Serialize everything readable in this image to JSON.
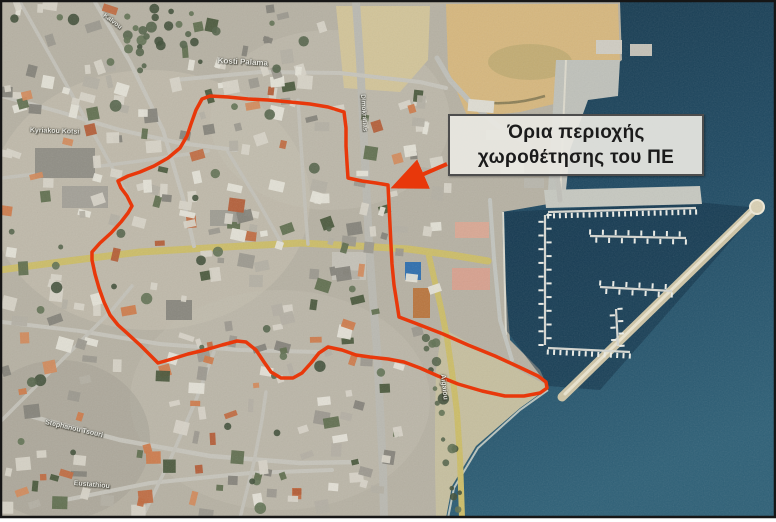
{
  "map": {
    "type": "satellite-aerial-photo",
    "callout": {
      "line1": "Όρια περιοχής",
      "line2": "χωροθέτησης του ΠΕ"
    },
    "street_labels": [
      {
        "text": "Kosti Palama",
        "x": 218,
        "y": 56,
        "rot": 3,
        "size": 8
      },
      {
        "text": "Kyriakou Kotsi",
        "x": 30,
        "y": 127,
        "rot": 2,
        "size": 7
      },
      {
        "text": "Kalvou",
        "x": 106,
        "y": 12,
        "rot": 38,
        "size": 6.5
      },
      {
        "text": "Dimokratias",
        "x": 366,
        "y": 94,
        "rot": 86,
        "size": 6.5
      },
      {
        "text": "Stephanou Tsouri",
        "x": 46,
        "y": 419,
        "rot": 13,
        "size": 7
      },
      {
        "text": "Eustathiou",
        "x": 74,
        "y": 480,
        "rot": 5,
        "size": 7
      },
      {
        "text": "Aigaiou",
        "x": 446,
        "y": 374,
        "rot": 84,
        "size": 7
      }
    ],
    "boundary": {
      "color": "#e8380b",
      "stroke_width": 3.5,
      "points": [
        [
          210,
          96
        ],
        [
          228,
          97
        ],
        [
          248,
          99
        ],
        [
          268,
          100
        ],
        [
          290,
          102
        ],
        [
          310,
          104
        ],
        [
          328,
          107
        ],
        [
          344,
          112
        ],
        [
          346,
          128
        ],
        [
          346,
          146
        ],
        [
          347,
          163
        ],
        [
          348,
          178
        ],
        [
          362,
          181
        ],
        [
          376,
          183
        ],
        [
          388,
          185
        ],
        [
          389,
          205
        ],
        [
          390,
          225
        ],
        [
          391,
          245
        ],
        [
          392,
          264
        ],
        [
          394,
          285
        ],
        [
          397,
          304
        ],
        [
          399,
          317
        ],
        [
          420,
          325
        ],
        [
          443,
          334
        ],
        [
          468,
          345
        ],
        [
          495,
          356
        ],
        [
          519,
          367
        ],
        [
          538,
          376
        ],
        [
          546,
          382
        ],
        [
          547,
          388
        ],
        [
          540,
          393
        ],
        [
          524,
          396
        ],
        [
          505,
          396
        ],
        [
          482,
          391
        ],
        [
          458,
          384
        ],
        [
          438,
          376
        ],
        [
          420,
          368
        ],
        [
          404,
          362
        ],
        [
          388,
          359
        ],
        [
          370,
          357
        ],
        [
          356,
          355
        ],
        [
          342,
          350
        ],
        [
          328,
          347
        ],
        [
          319,
          353
        ],
        [
          311,
          363
        ],
        [
          302,
          373
        ],
        [
          293,
          378
        ],
        [
          281,
          378
        ],
        [
          271,
          372
        ],
        [
          264,
          362
        ],
        [
          256,
          350
        ],
        [
          246,
          342
        ],
        [
          237,
          341
        ],
        [
          222,
          345
        ],
        [
          205,
          350
        ],
        [
          188,
          354
        ],
        [
          172,
          359
        ],
        [
          158,
          363
        ],
        [
          149,
          354
        ],
        [
          140,
          345
        ],
        [
          128,
          334
        ],
        [
          118,
          325
        ],
        [
          110,
          315
        ],
        [
          104,
          302
        ],
        [
          99,
          288
        ],
        [
          95,
          274
        ],
        [
          92,
          260
        ],
        [
          92,
          252
        ],
        [
          100,
          243
        ],
        [
          111,
          233
        ],
        [
          121,
          222
        ],
        [
          128,
          213
        ],
        [
          132,
          206
        ],
        [
          127,
          196
        ],
        [
          121,
          188
        ],
        [
          118,
          181
        ],
        [
          128,
          176
        ],
        [
          140,
          172
        ],
        [
          154,
          166
        ],
        [
          168,
          158
        ],
        [
          180,
          148
        ],
        [
          187,
          136
        ],
        [
          191,
          124
        ],
        [
          196,
          110
        ],
        [
          202,
          99
        ],
        [
          210,
          96
        ]
      ]
    },
    "arrow": {
      "from": [
        447,
        164
      ],
      "to": [
        396,
        186
      ]
    },
    "colors": {
      "frame": "#161616",
      "land": "#b6b1a3",
      "sea_deep": "#16384d",
      "sea_mid": "#1f4a63",
      "sea_shallow": "#2e6077",
      "marina_water": "#0d2c42",
      "castle_sand": "#d6b77e",
      "beach": "#c6bf9f",
      "road_yellow": "#ccbd69",
      "roof_orange": "#c06a40"
    }
  }
}
